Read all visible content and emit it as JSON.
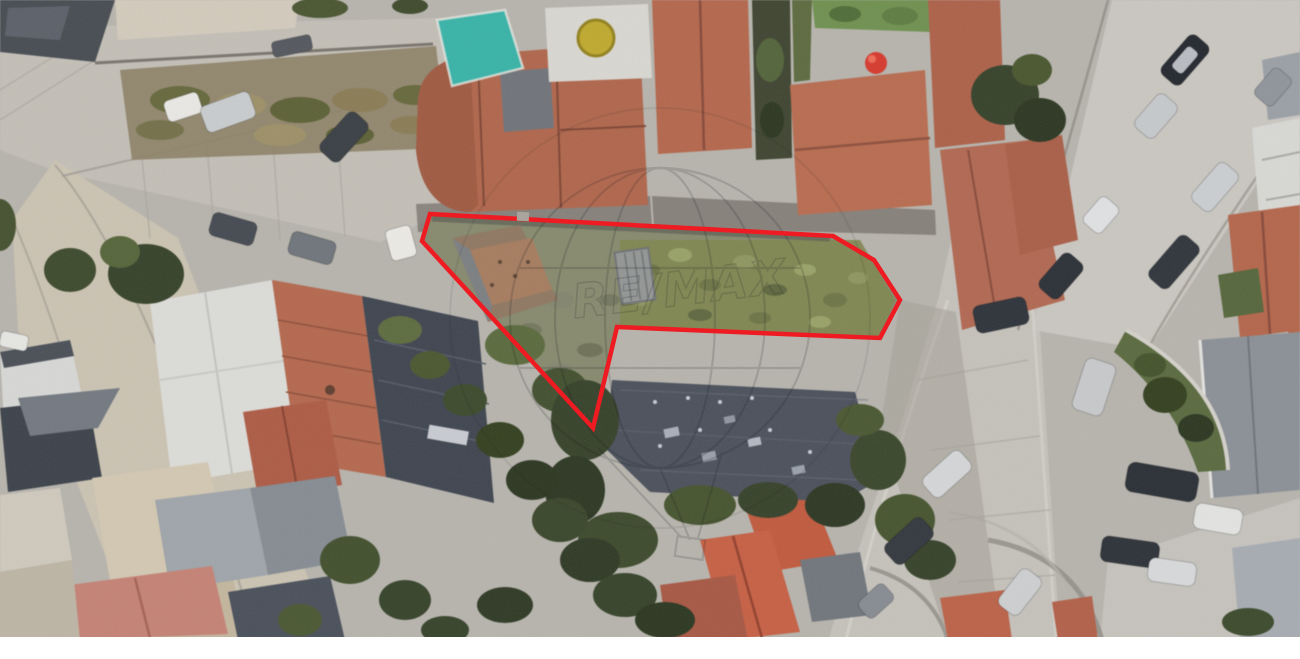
{
  "canvas": {
    "width": 1300,
    "height": 659,
    "photo_height": 637,
    "letterbox_color": "#ffffff"
  },
  "watermark": {
    "text": "RE/MAX",
    "color": "#15181b",
    "opacity": 0.15
  },
  "boundary": {
    "color": "#ee1b23",
    "stroke_width": 4.5,
    "points_attr": "430,214 833,236 874,260 900,300 880,338 617,327 593,428 422,241",
    "vertices": [
      [
        430,
        214
      ],
      [
        833,
        236
      ],
      [
        874,
        260
      ],
      [
        900,
        300
      ],
      [
        880,
        338
      ],
      [
        617,
        327
      ],
      [
        593,
        428
      ],
      [
        422,
        241
      ]
    ]
  },
  "palette": {
    "pavement": "#bdbab2",
    "street_light": "#c9c6c0",
    "roof_terracotta": "#b2664c",
    "roof_bright_orange": "#c35a3d",
    "roof_slate": "#3f4550",
    "roof_white": "#dcdcd8",
    "field_olive": "#7f854f",
    "vegetation_dark": "#36422a",
    "teal_canopy": "#39b3a8",
    "boundary_red": "#ee1b23"
  }
}
